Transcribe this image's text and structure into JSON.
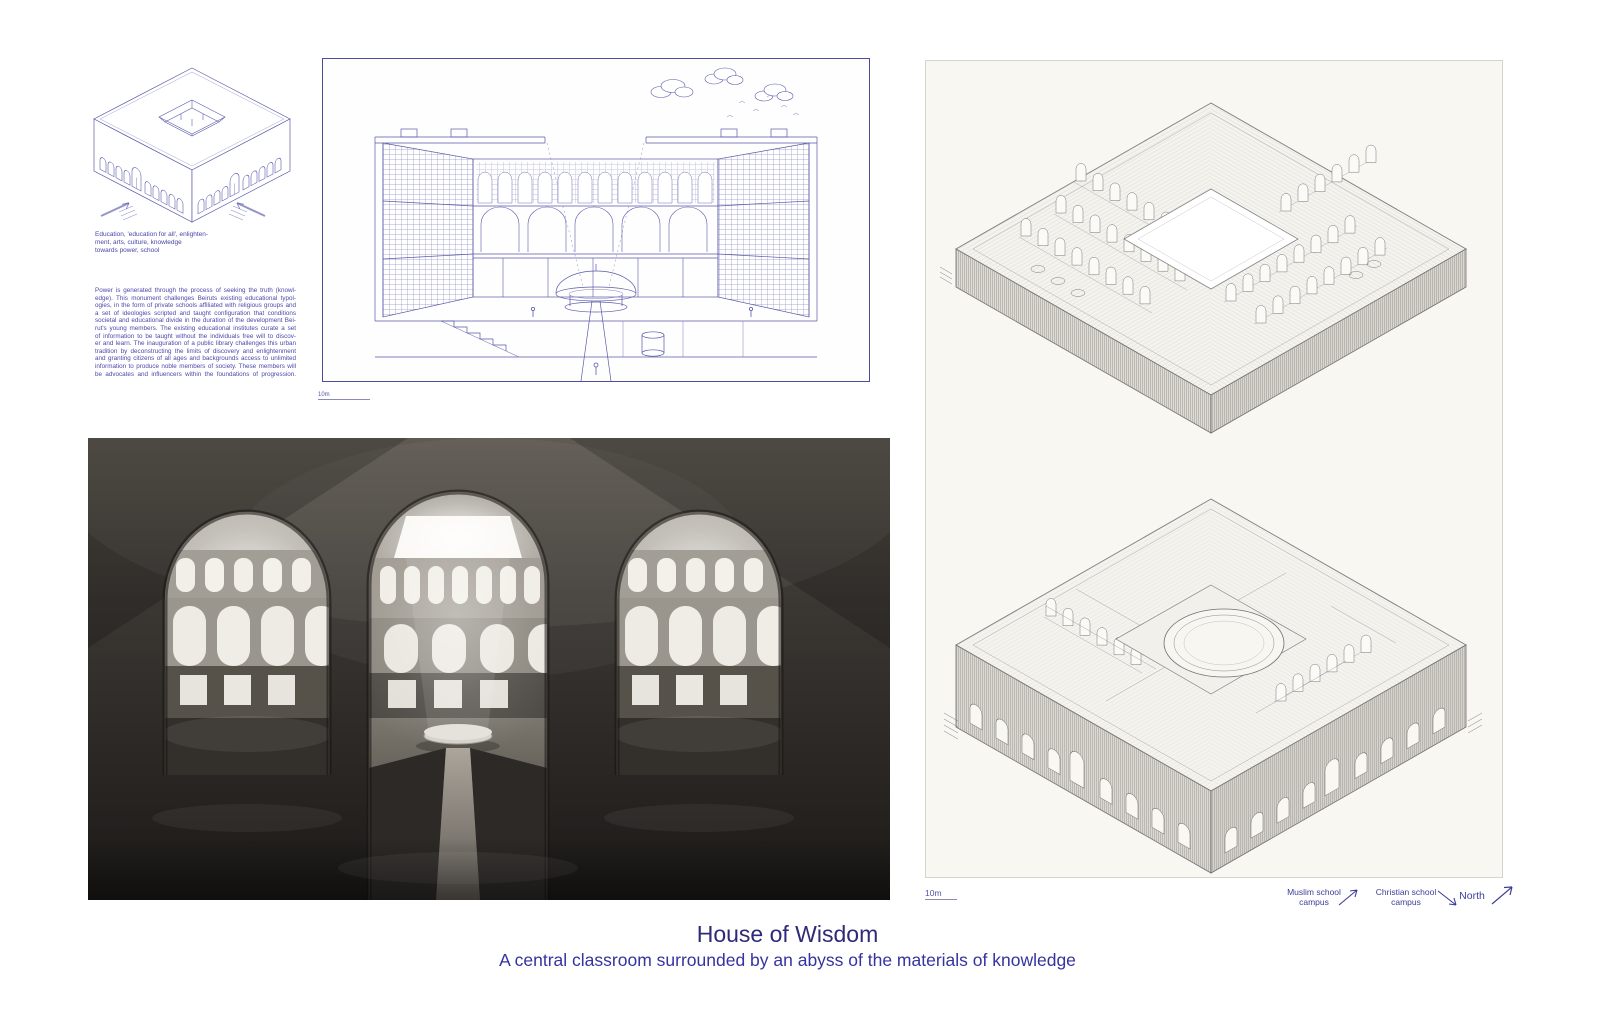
{
  "page": {
    "colors": {
      "text_blue": "#4646a8",
      "blueprint_line": "#5a5aab",
      "title_color": "#2d2b77",
      "subtitle_color": "#3533a0",
      "panel_background": "#f8f7f2",
      "render_dark": "#2b2825"
    }
  },
  "concept": {
    "caption_lines": [
      "Education, 'education for all', enlighten-",
      "ment, arts, culture, knowledge",
      "towards power, school"
    ],
    "paragraph_lines": [
      "Power is generated through the process of seeking the truth (knowl-",
      "edge). This monument challenges Beiruts existing educational typol-",
      "ogies, in the form of private schools affiliated with religious groups and",
      "a set of ideologies scripted and taught configuration that conditions",
      "societal and educational divide in the duration of the development Bei-",
      "rut's young members. The existing educational institutes curate a set",
      "of information to be taught without the individuals free will to discov-",
      "er and learn. The inauguration of a public library challenges this urban",
      "tradition by deconstructing the limits of discovery and enlightenment",
      "and granting citizens of all ages and backgrounds access to unlimited",
      "information to produce noble members of society. These members will",
      "be advocates and influencers within the foundations of progression."
    ]
  },
  "section_drawing": {
    "scale_label": "10m"
  },
  "axon_panel": {
    "scale_label": "10m"
  },
  "compass": {
    "muslim": {
      "line1": "Muslim school",
      "line2": "campus"
    },
    "christian": {
      "line1": "Christian school",
      "line2": "campus"
    },
    "north": {
      "label": "North"
    }
  },
  "footer": {
    "title": "House of Wisdom",
    "subtitle": "A central classroom surrounded by an abyss of the materials of knowledge"
  }
}
